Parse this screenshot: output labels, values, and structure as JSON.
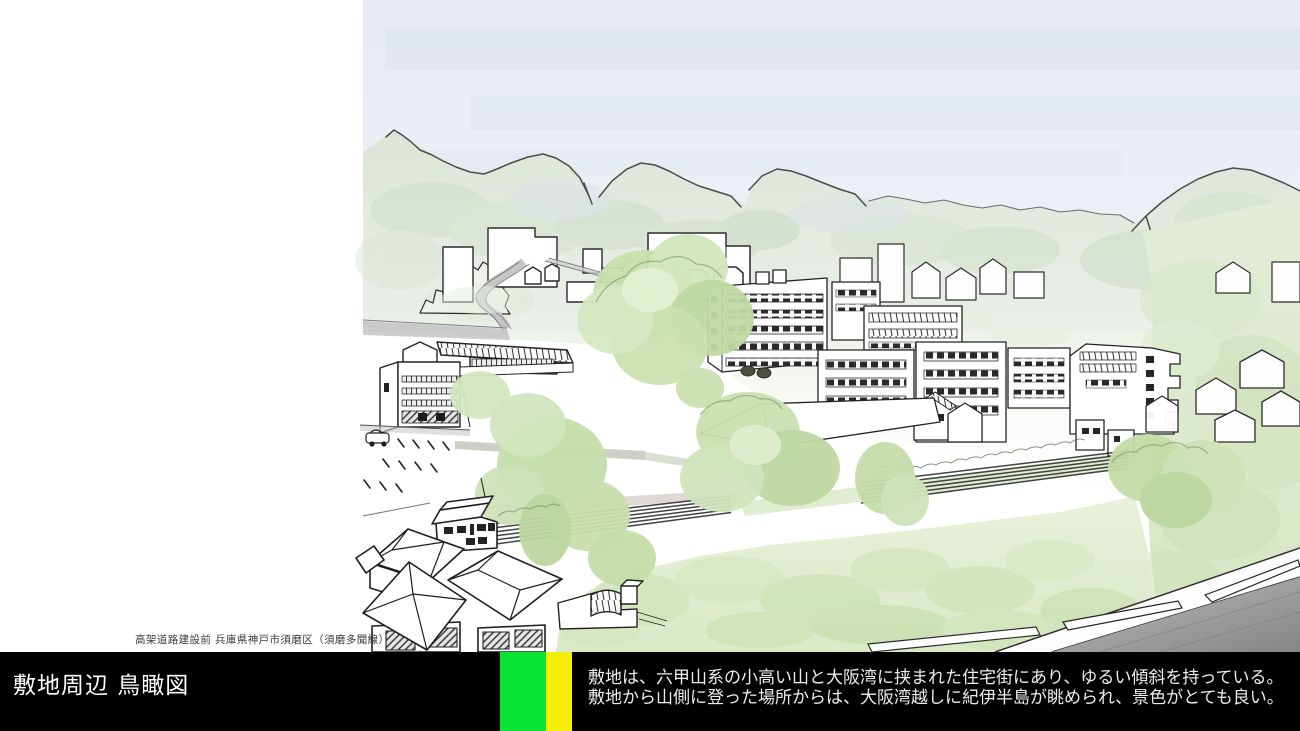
{
  "slide": {
    "caption": "高架道路建設前 兵庫県神戸市須磨区（須磨多聞線）",
    "title": "敷地周辺 鳥瞰図",
    "description": {
      "line1": "敷地は、六甲山系の小高い山と大阪湾に挟まれた住宅街にあり、ゆるい傾斜を持っている。",
      "line2": "敷地から山側に登った場所からは、大阪湾越しに紀伊半島が眺められ、景色がとても良い。"
    },
    "footer": {
      "bar_color": "#000000",
      "accent_green": "#0ae234",
      "accent_yellow": "#f5ee06",
      "text_color": "#ededed"
    },
    "illustration": {
      "type": "hand-drawn watercolor bird's-eye view of site surroundings",
      "palette": {
        "sky": "#e8ecf4",
        "mountain_wash": "#dde7d8",
        "tree_green": "#c6deac",
        "road_gray": "#9e9e9e",
        "ink": "#2b2b2b"
      }
    }
  }
}
